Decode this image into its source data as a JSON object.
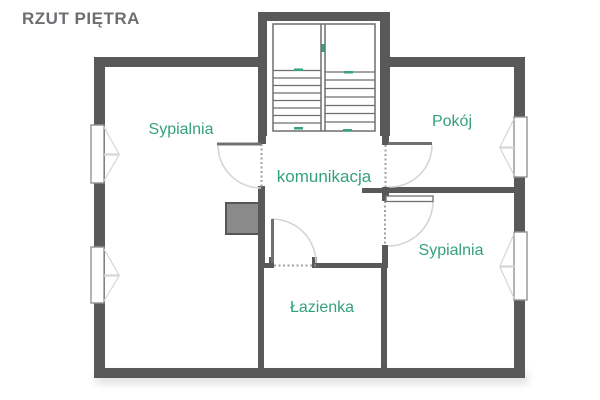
{
  "title": "RZUT PIĘTRA",
  "rooms": [
    {
      "id": "sypialnia-1",
      "label": "Sypialnia"
    },
    {
      "id": "pokoj",
      "label": "Pokój"
    },
    {
      "id": "komunikacja",
      "label": "komunikacja"
    },
    {
      "id": "sypialnia-2",
      "label": "Sypialnia"
    },
    {
      "id": "lazienka",
      "label": "Łazienka"
    }
  ],
  "features": {
    "staircase": "double-flight staircase with top landing",
    "windows": 4,
    "doors": 4,
    "chimney": "masonry shaft"
  },
  "colors": {
    "background": "#ffffff",
    "wall": "#595959",
    "room_label": "#35a17c",
    "title": "#6d6d72",
    "thin_line": "#6e6e6e",
    "door_leaf": "#707070",
    "door_arc": "#d2d6d9",
    "opening_dash": "#9aa0a4",
    "window_border": "#8f9498",
    "chimney_fill": "#8a8a8a",
    "chimney_border": "#565656",
    "stair_mark": "#3aa37e"
  }
}
